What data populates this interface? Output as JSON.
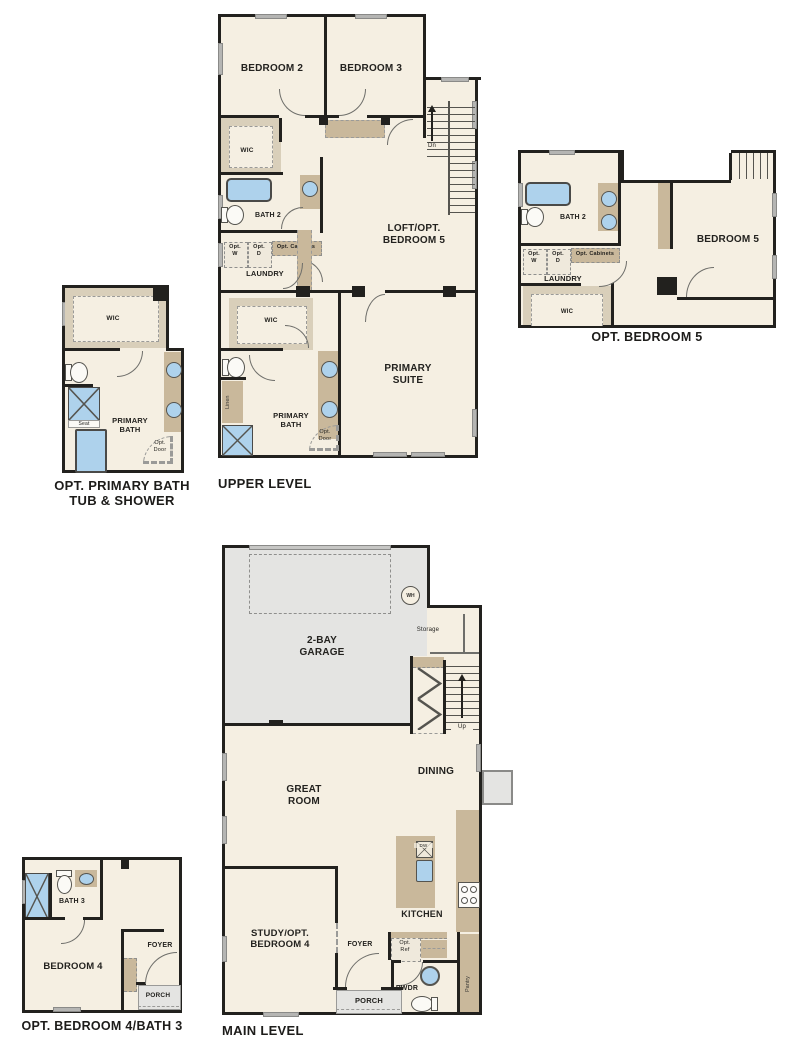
{
  "colors": {
    "floor": "#f5efe2",
    "wall": "#22211e",
    "cabinet_tan": "#c9b89b",
    "closet_tan": "#d9cfba",
    "hard_surface_gray": "#e4e4e2",
    "fixture_blue": "#aed2ec"
  },
  "upper_level": {
    "title": "UPPER LEVEL",
    "bedroom2": "BEDROOM 2",
    "bedroom3": "BEDROOM 3",
    "wic": "WIC",
    "bath2": "BATH 2",
    "opt_w": "Opt.\nW",
    "opt_d": "Opt.\nD",
    "opt_cabinets": "Opt. Cabinets",
    "laundry": "LAUNDRY",
    "dn": "Dn",
    "loft": "LOFT/OPT.\nBEDROOM 5",
    "wic2": "WIC",
    "linen": "Linen",
    "primary_bath": "PRIMARY\nBATH",
    "opt_door": "Opt.\nDoor",
    "primary_suite": "PRIMARY\nSUITE"
  },
  "opt_bedroom5": {
    "title": "OPT. BEDROOM 5",
    "bath2": "BATH 2",
    "opt_w": "Opt.\nW",
    "opt_d": "Opt.\nD",
    "opt_cabinets": "Opt. Cabinets",
    "laundry": "LAUNDRY",
    "wic": "WIC",
    "bedroom5": "BEDROOM 5"
  },
  "opt_primary_bath": {
    "title": "OPT. PRIMARY BATH\nTUB & SHOWER",
    "wic": "WIC",
    "seat": "Seat",
    "primary_bath": "PRIMARY\nBATH",
    "opt_door": "Opt.\nDoor"
  },
  "main_level": {
    "title": "MAIN LEVEL",
    "garage": "2-BAY\nGARAGE",
    "wh": "WH",
    "storage": "Storage",
    "up": "Up",
    "great_room": "GREAT\nROOM",
    "dining": "DINING",
    "kitchen": "KITCHEN",
    "dw": "DW",
    "opt_ref": "Opt.\nRef",
    "pwdr": "PWDR",
    "pantry": "Pantry",
    "study": "STUDY/OPT.\nBEDROOM 4",
    "foyer": "FOYER",
    "porch": "PORCH"
  },
  "opt_bedroom4": {
    "title": "OPT. BEDROOM 4/BATH 3",
    "bath3": "BATH 3",
    "bedroom4": "BEDROOM 4",
    "foyer": "FOYER",
    "porch": "PORCH"
  }
}
